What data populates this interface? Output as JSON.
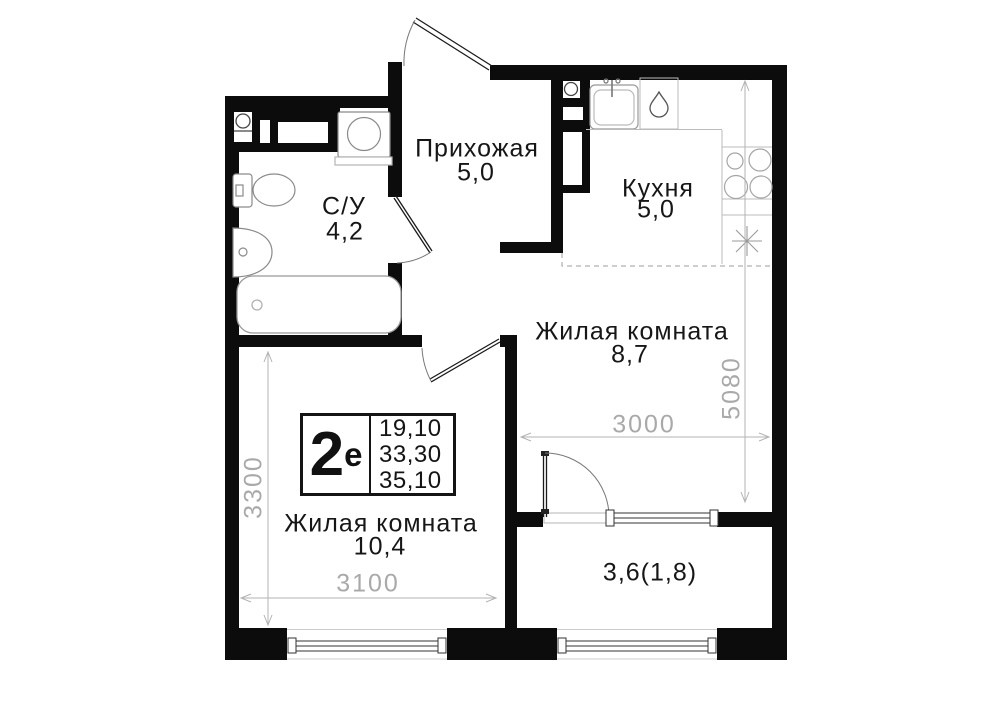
{
  "rooms": {
    "hallway": {
      "name": "Прихожая",
      "area": "5,0"
    },
    "kitchen": {
      "name": "Кухня",
      "area": "5,0"
    },
    "bathroom": {
      "name": "С/У",
      "area": "4,2"
    },
    "living_main": {
      "name": "Жилая комната",
      "area": "8,7"
    },
    "living_second": {
      "name": "Жилая комната",
      "area": "10,4"
    },
    "balcony": {
      "area": "3,6(1,8)"
    }
  },
  "stamp": {
    "type_number": "2",
    "type_letter": "е",
    "values": [
      "19,10",
      "33,30",
      "35,10"
    ]
  },
  "dimensions": {
    "living_second_height": "3300",
    "living_second_width": "3100",
    "living_main_width": "3000",
    "right_side_height": "5080"
  },
  "colors": {
    "wall": "#0c0c0c",
    "fixture": "#999999",
    "dimension": "#aaaaaa",
    "text": "#161616",
    "background": "#ffffff"
  },
  "icons": [
    "entrance-door-icon",
    "bathroom-door-icon",
    "room-door-icon",
    "balcony-door-icon",
    "window-icon",
    "toilet-icon",
    "bathroom-sink-icon",
    "bathtub-icon",
    "washing-machine-icon",
    "ventilation-icon",
    "kitchen-sink-icon",
    "water-drop-icon",
    "stove-burners-icon",
    "light-star-icon"
  ]
}
